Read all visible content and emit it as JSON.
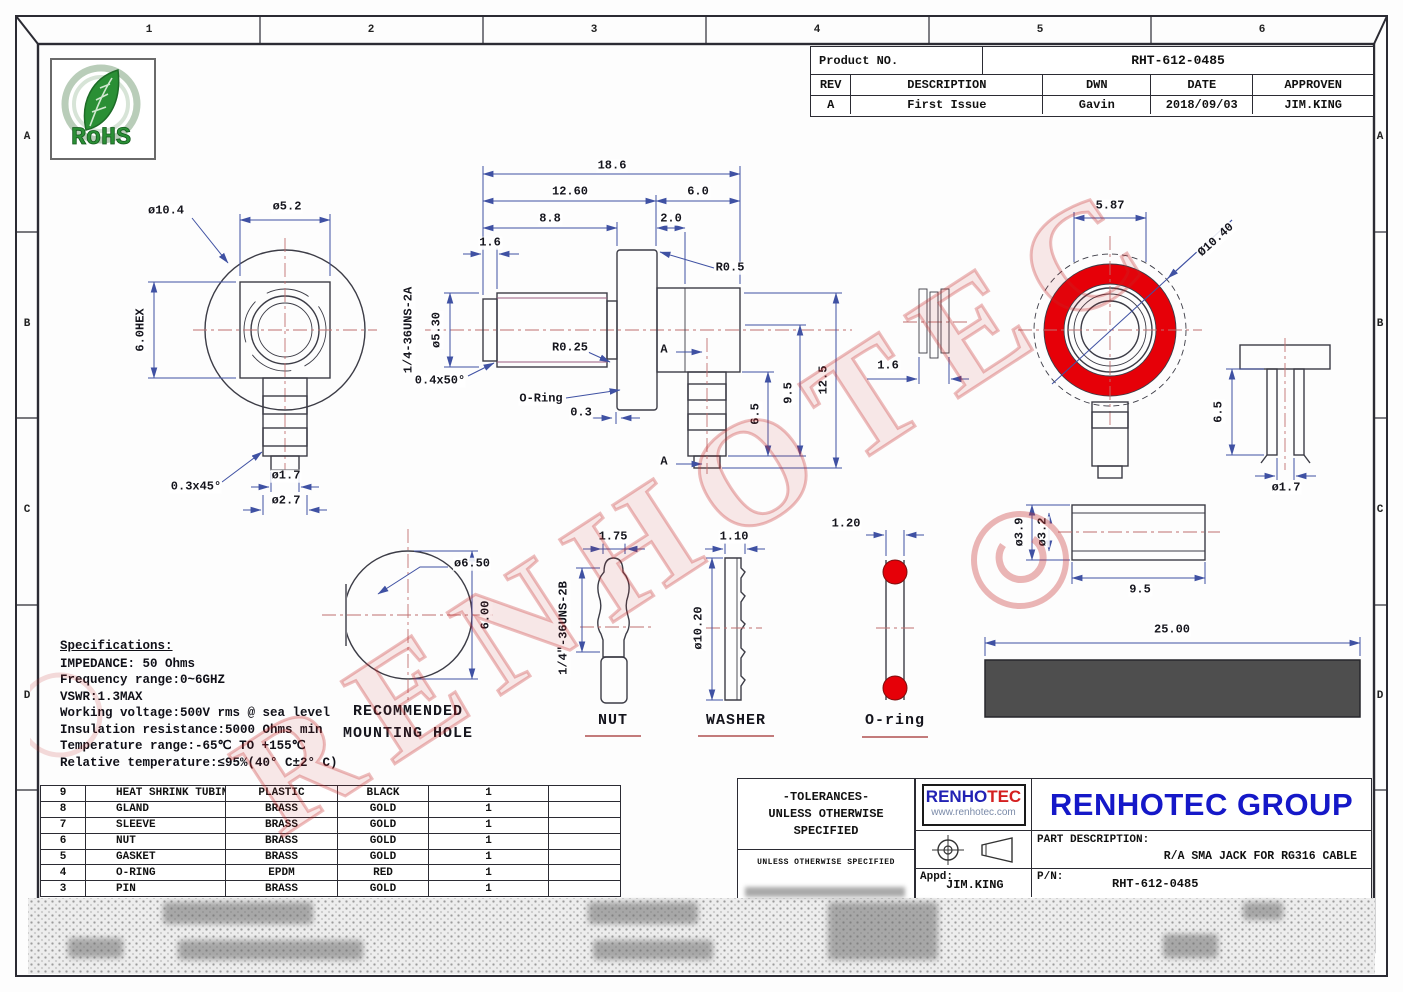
{
  "product_table": {
    "label": "Product NO.",
    "number": "RHT-612-0485",
    "headers": [
      "REV",
      "DESCRIPTION",
      "DWN",
      "DATE",
      "APPROVEN"
    ],
    "row": [
      "A",
      "First Issue",
      "Gavin",
      "2018/09/03",
      "JIM.KING"
    ]
  },
  "rohs": {
    "label": "RoHS"
  },
  "specifications": {
    "heading": "Specifications:",
    "lines": [
      "IMPEDANCE: 50 Ohms",
      "Frequency range:0~6GHZ",
      "VSWR:1.3MAX",
      "Working voltage:500V rms @ sea level",
      "Insulation resistance:5000 Ohms min",
      "Temperature range:-65℃ TO +155℃",
      "Relative temperature:≤95%(40° C±2° C)"
    ]
  },
  "bom": {
    "rows": [
      [
        "9",
        "HEAT SHRINK TUBING",
        "PLASTIC",
        "BLACK",
        "1",
        ""
      ],
      [
        "8",
        "GLAND",
        "BRASS",
        "GOLD",
        "1",
        ""
      ],
      [
        "7",
        "SLEEVE",
        "BRASS",
        "GOLD",
        "1",
        ""
      ],
      [
        "6",
        "NUT",
        "BRASS",
        "GOLD",
        "1",
        ""
      ],
      [
        "5",
        "GASKET",
        "BRASS",
        "GOLD",
        "1",
        ""
      ],
      [
        "4",
        "O-RING",
        "EPDM",
        "RED",
        "1",
        ""
      ],
      [
        "3",
        "PIN",
        "BRASS",
        "GOLD",
        "1",
        ""
      ]
    ]
  },
  "tolerance_box": {
    "line1": "-TOLERANCES-",
    "line2": "UNLESS OTHERWISE",
    "line3": "SPECIFIED",
    "small_note": "UNLESS OTHERWISE SPECIFIED"
  },
  "title_block": {
    "logo_part1": "RENHO",
    "logo_part2": "TEC",
    "logo_url": "www.renhotec.com",
    "company": "RENHOTEC GROUP",
    "part_description_label": "PART DESCRIPTION:",
    "part_description": "R/A SMA JACK FOR RG316 CABLE",
    "appd_label": "Appd:",
    "appd": "JIM.KING",
    "pn_label": "P/N:",
    "pn": "RHT-612-0485"
  },
  "watermark": {
    "text": "RENHOTEC"
  },
  "colors": {
    "accent_red": "#e60008",
    "dim_blue": "#3f51a3",
    "line_dark": "#3c3c46",
    "centerline_red": "#c07070",
    "thread_purple": "#9a5b80",
    "green_line": "#58b158",
    "heatshrink": "#4e4e4e",
    "brand_blue": "#1518c8",
    "logo_red": "#d42020",
    "rohs_green": "#2a8f35",
    "watermark_red": "#c83232"
  },
  "drawing": {
    "annotations": [
      {
        "name": "zone-1",
        "text": "1",
        "x": 149,
        "y": 31,
        "cls": "zone"
      },
      {
        "name": "zone-2",
        "text": "2",
        "x": 371,
        "y": 31,
        "cls": "zone"
      },
      {
        "name": "zone-3",
        "text": "3",
        "x": 594,
        "y": 31,
        "cls": "zone"
      },
      {
        "name": "zone-4",
        "text": "4",
        "x": 817,
        "y": 31,
        "cls": "zone"
      },
      {
        "name": "zone-5",
        "text": "5",
        "x": 1040,
        "y": 31,
        "cls": "zone"
      },
      {
        "name": "zone-6",
        "text": "6",
        "x": 1262,
        "y": 31,
        "cls": "zone"
      },
      {
        "name": "zone-a-left",
        "text": "A",
        "x": 27,
        "y": 138,
        "cls": "zone"
      },
      {
        "name": "zone-b-left",
        "text": "B",
        "x": 27,
        "y": 325,
        "cls": "zone"
      },
      {
        "name": "zone-c-left",
        "text": "C",
        "x": 27,
        "y": 511,
        "cls": "zone"
      },
      {
        "name": "zone-d-left",
        "text": "D",
        "x": 27,
        "y": 697,
        "cls": "zone"
      },
      {
        "name": "zone-a-right",
        "text": "A",
        "x": 1380,
        "y": 138,
        "cls": "zone"
      },
      {
        "name": "zone-b-right",
        "text": "B",
        "x": 1380,
        "y": 325,
        "cls": "zone"
      },
      {
        "name": "zone-c-right",
        "text": "C",
        "x": 1380,
        "y": 511,
        "cls": "zone"
      },
      {
        "name": "zone-d-right",
        "text": "D",
        "x": 1380,
        "y": 697,
        "cls": "zone"
      },
      {
        "name": "dim-dia10-4",
        "text": "ø10.4",
        "x": 166,
        "y": 211
      },
      {
        "name": "dim-dia5-2",
        "text": "ø5.2",
        "x": 287,
        "y": 207
      },
      {
        "name": "dim-6-0hex",
        "text": "6.0HEX",
        "x": 141,
        "y": 330,
        "rot": -90
      },
      {
        "name": "dim-0-3x45",
        "text": "0.3x45°",
        "x": 196,
        "y": 487
      },
      {
        "name": "dim-dia1-7-left",
        "text": "ø1.7",
        "x": 286,
        "y": 476
      },
      {
        "name": "dim-dia2-7",
        "text": "ø2.7",
        "x": 286,
        "y": 501
      },
      {
        "name": "dim-18-6",
        "text": "18.6",
        "x": 612,
        "y": 166
      },
      {
        "name": "dim-12-60",
        "text": "12.60",
        "x": 570,
        "y": 192
      },
      {
        "name": "dim-6-0",
        "text": "6.0",
        "x": 698,
        "y": 192
      },
      {
        "name": "dim-8-8",
        "text": "8.8",
        "x": 550,
        "y": 219
      },
      {
        "name": "dim-2-0",
        "text": "2.0",
        "x": 671,
        "y": 219
      },
      {
        "name": "dim-1-6-main",
        "text": "1.6",
        "x": 490,
        "y": 243
      },
      {
        "name": "dim-r0-5",
        "text": "R0.5",
        "x": 730,
        "y": 268
      },
      {
        "name": "dim-dia5-30",
        "text": "ø5.30",
        "x": 437,
        "y": 330,
        "rot": -90
      },
      {
        "name": "thread-label-2a",
        "text": "1/4-36UNS-2A",
        "x": 409,
        "y": 330,
        "rot": -90
      },
      {
        "name": "dim-r0-25",
        "text": "R0.25",
        "x": 570,
        "y": 348
      },
      {
        "name": "dim-0-4x50",
        "text": "0.4x50°",
        "x": 440,
        "y": 381
      },
      {
        "name": "label-o-ring-callout",
        "text": "O-Ring",
        "x": 541,
        "y": 399
      },
      {
        "name": "dim-0-3",
        "text": "0.3",
        "x": 581,
        "y": 413
      },
      {
        "name": "section-a-top",
        "text": "A",
        "x": 664,
        "y": 350
      },
      {
        "name": "section-a-bottom",
        "text": "A",
        "x": 664,
        "y": 462
      },
      {
        "name": "dim-6-5-main",
        "text": "6.5",
        "x": 756,
        "y": 414,
        "rot": -90
      },
      {
        "name": "dim-9-5-main",
        "text": "9.5",
        "x": 789,
        "y": 393,
        "rot": -90
      },
      {
        "name": "dim-12-5",
        "text": "12.5",
        "x": 824,
        "y": 380,
        "rot": -90
      },
      {
        "name": "dim-1-6-gasket",
        "text": "1.6",
        "x": 888,
        "y": 366
      },
      {
        "name": "dim-5-87",
        "text": "5.87",
        "x": 1110,
        "y": 206
      },
      {
        "name": "dim-dia10-40",
        "text": "Ø10.40",
        "x": 1216,
        "y": 240,
        "rot": -42
      },
      {
        "name": "dim-6-5-pin",
        "text": "6.5",
        "x": 1219,
        "y": 412,
        "rot": -90
      },
      {
        "name": "dim-dia1-7-pin",
        "text": "ø1.7",
        "x": 1286,
        "y": 488
      },
      {
        "name": "dim-dia3-9",
        "text": "ø3.9",
        "x": 1020,
        "y": 532,
        "rot": -90
      },
      {
        "name": "dim-dia3-2",
        "text": "ø3.2",
        "x": 1043,
        "y": 532,
        "rot": -90
      },
      {
        "name": "dim-9-5-sleeve",
        "text": "9.5",
        "x": 1140,
        "y": 590
      },
      {
        "name": "dim-dia6-50",
        "text": "ø6.50",
        "x": 472,
        "y": 564
      },
      {
        "name": "dim-6-00",
        "text": "6.00",
        "x": 486,
        "y": 615,
        "rot": -90
      },
      {
        "name": "caption-recommended",
        "text": "RECOMMENDED",
        "x": 408,
        "y": 712,
        "cls": "caption"
      },
      {
        "name": "caption-mounting-hole",
        "text": "MOUNTING HOLE",
        "x": 408,
        "y": 734,
        "cls": "caption"
      },
      {
        "name": "dim-1-75",
        "text": "1.75",
        "x": 613,
        "y": 537
      },
      {
        "name": "thread-label-2b",
        "text": "1/4\"-36UNS-2B",
        "x": 564,
        "y": 628,
        "rot": -90
      },
      {
        "name": "caption-nut",
        "text": "NUT",
        "x": 613,
        "y": 721,
        "cls": "caption"
      },
      {
        "name": "dim-1-10",
        "text": "1.10",
        "x": 734,
        "y": 537
      },
      {
        "name": "dim-dia10-20",
        "text": "ø10.20",
        "x": 699,
        "y": 628,
        "rot": -90
      },
      {
        "name": "caption-washer",
        "text": "WASHER",
        "x": 736,
        "y": 721,
        "cls": "caption"
      },
      {
        "name": "dim-1-20",
        "text": "1.20",
        "x": 846,
        "y": 524
      },
      {
        "name": "caption-o-ring",
        "text": "O-ring",
        "x": 895,
        "y": 721,
        "cls": "caption"
      },
      {
        "name": "dim-25-00",
        "text": "25.00",
        "x": 1172,
        "y": 630
      }
    ]
  }
}
